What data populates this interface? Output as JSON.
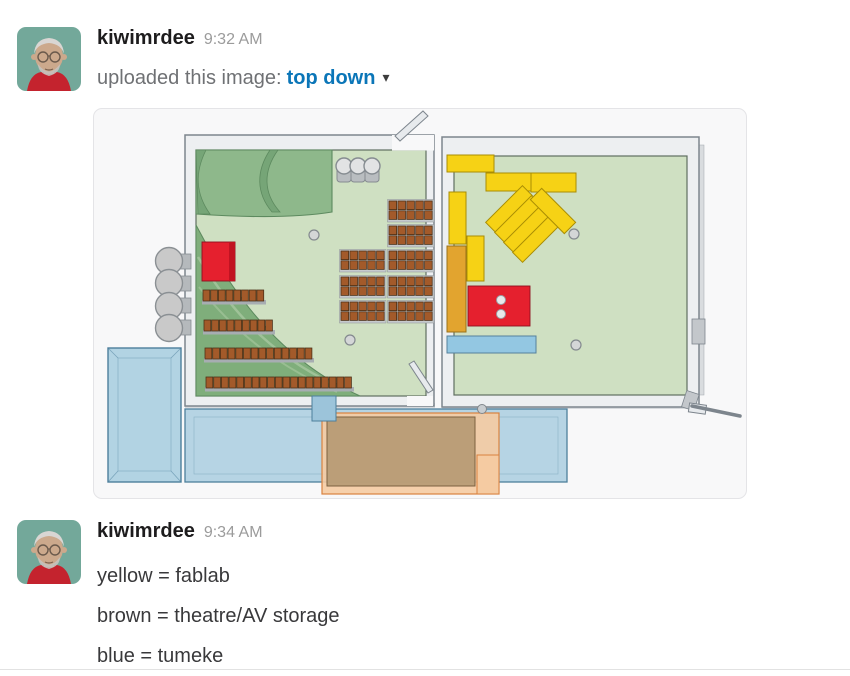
{
  "colors": {
    "username": "#1d1c1d",
    "timestamp": "#9b9b9b",
    "upload_text": "#6f7174",
    "file_link_blue": "#0b76b8",
    "message_text": "#39393b",
    "legend_yellow": "#f6d215",
    "legend_brown": "#b69a74",
    "legend_blue": "#aacee0",
    "floor_green": "#cfe0c2",
    "stage_green": "#8eb88b",
    "seat_brown": "#a35a2a",
    "accent_red": "#e5202e",
    "accent_orange": "#e2a42f"
  },
  "messages": [
    {
      "user": "kiwimrdee",
      "timestamp": "9:32 AM",
      "action_text": "uploaded this image:",
      "file_name": "top down",
      "file_menu_icon": "▾"
    },
    {
      "user": "kiwimrdee",
      "timestamp": "9:34 AM",
      "lines": [
        "yellow = fablab",
        "brown = theatre/AV storage",
        "blue = tumeke"
      ]
    }
  ],
  "attachment": {
    "kind": "top-down 3D floor plan render",
    "areas": [
      {
        "color": "yellow",
        "label": "fablab"
      },
      {
        "color": "brown",
        "label": "theatre/AV storage"
      },
      {
        "color": "blue",
        "label": "tumeke"
      }
    ]
  }
}
